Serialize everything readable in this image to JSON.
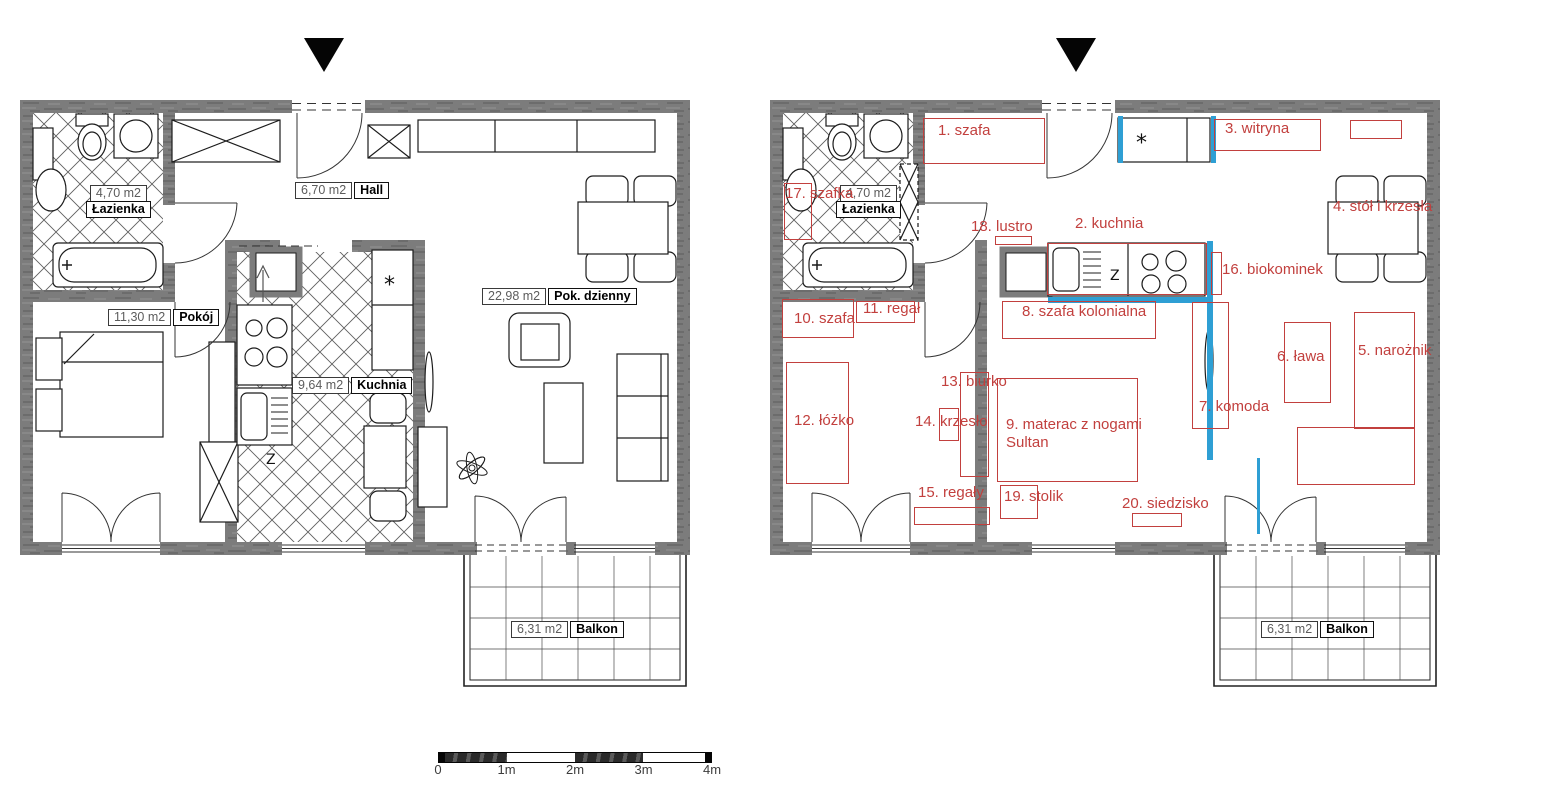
{
  "colors": {
    "wall": "#7c7c7c",
    "annotation_red": "#c2403e",
    "highlight_blue": "#2e9fd4",
    "ink": "#222222"
  },
  "left_plan": {
    "room_labels": [
      {
        "area": "4,70 m2",
        "name": "Łazienka",
        "x": 66,
        "y": 85,
        "stacked": true
      },
      {
        "area": "6,70 m2",
        "name": "Hall",
        "x": 275,
        "y": 82
      },
      {
        "area": "11,30 m2",
        "name": "Pokój",
        "x": 88,
        "y": 209
      },
      {
        "area": "9,64 m2",
        "name": "Kuchnia",
        "x": 272,
        "y": 277
      },
      {
        "area": "22,98 m2",
        "name": "Pok. dzienny",
        "x": 462,
        "y": 188
      },
      {
        "area": "6,31 m2",
        "name": "Balkon",
        "x": 491,
        "y": 521
      }
    ]
  },
  "right_plan": {
    "room_labels": [
      {
        "area": "4,70 m2",
        "name": "Łazienka",
        "x": 66,
        "y": 85,
        "stacked": true
      },
      {
        "area": "6,31 m2",
        "name": "Balkon",
        "x": 491,
        "y": 521
      }
    ],
    "furniture": [
      {
        "lines": [
          "1. szafa"
        ],
        "box": [
          153,
          18,
          120,
          44
        ],
        "lx": 168,
        "ly": 22
      },
      {
        "lines": [
          "2. kuchnia"
        ],
        "box": [
          277,
          143,
          158,
          50
        ],
        "lx": 305,
        "ly": 115
      },
      {
        "lines": [
          "3. witryna"
        ],
        "box": [
          444,
          19,
          105,
          30
        ],
        "lx": 455,
        "ly": 20
      },
      {
        "lines": [
          "4. stół i krzesła"
        ],
        "box": null,
        "lx": 563,
        "ly": 98
      },
      {
        "lines": [
          "5. narożnik"
        ],
        "box": [
          584,
          212,
          59,
          115
        ],
        "box2": [
          527,
          327,
          116,
          56
        ],
        "lx": 588,
        "ly": 242
      },
      {
        "lines": [
          "6. ława"
        ],
        "box": [
          514,
          222,
          45,
          79
        ],
        "lx": 507,
        "ly": 248
      },
      {
        "lines": [
          "7. komoda"
        ],
        "box": [
          422,
          202,
          35,
          125
        ],
        "lx": 429,
        "ly": 298
      },
      {
        "lines": [
          "8. szafa kolonialna"
        ],
        "box": [
          232,
          201,
          152,
          36
        ],
        "lx": 252,
        "ly": 203
      },
      {
        "lines": [
          "9. materac z nogami",
          "Sultan"
        ],
        "box": [
          227,
          278,
          139,
          102
        ],
        "lx": 236,
        "ly": 316
      },
      {
        "lines": [
          "10. szafa"
        ],
        "box": [
          12,
          199,
          70,
          37
        ],
        "lx": 24,
        "ly": 210
      },
      {
        "lines": [
          "11. regał"
        ],
        "box": [
          86,
          201,
          57,
          20
        ],
        "lx": 93,
        "ly": 200
      },
      {
        "lines": [
          "12. łóżko"
        ],
        "box": [
          16,
          262,
          61,
          120
        ],
        "lx": 24,
        "ly": 312
      },
      {
        "lines": [
          "13. biurko"
        ],
        "box": [
          190,
          272,
          27,
          103
        ],
        "lx": 171,
        "ly": 273
      },
      {
        "lines": [
          "14. krzesło"
        ],
        "box": [
          169,
          308,
          18,
          31
        ],
        "lx": 145,
        "ly": 313
      },
      {
        "lines": [
          "15. regały"
        ],
        "box": [
          144,
          407,
          74,
          16
        ],
        "lx": 148,
        "ly": 384
      },
      {
        "lines": [
          "16. biokominek"
        ],
        "box": [
          441,
          152,
          9,
          41
        ],
        "lx": 452,
        "ly": 161
      },
      {
        "lines": [
          "17. szafka"
        ],
        "box": [
          14,
          83,
          26,
          55
        ],
        "lx": 15,
        "ly": 85
      },
      {
        "lines": [
          "18. lustro"
        ],
        "box": [
          225,
          136,
          35,
          7
        ],
        "lx": 201,
        "ly": 118
      },
      {
        "lines": [
          "19. stolik"
        ],
        "box": [
          230,
          385,
          36,
          32
        ],
        "lx": 234,
        "ly": 388
      },
      {
        "lines": [
          "20. siedzisko"
        ],
        "box": [
          362,
          413,
          48,
          12
        ],
        "lx": 352,
        "ly": 395
      },
      {
        "lines": [],
        "box": [
          580,
          20,
          50,
          17
        ],
        "lx": 0,
        "ly": 0
      }
    ],
    "highlights": [
      [
        348,
        16,
        5,
        47
      ],
      [
        441,
        16,
        5,
        47
      ],
      [
        437,
        141,
        6,
        61
      ],
      [
        278,
        197,
        165,
        6
      ],
      [
        437,
        202,
        6,
        158
      ],
      [
        487,
        358,
        3,
        76
      ]
    ]
  },
  "scale_bar": {
    "labels": [
      "0",
      "1m",
      "2m",
      "3m",
      "4m"
    ]
  },
  "symbols": {
    "sink_z": "Z",
    "cabinet_star": "*"
  }
}
